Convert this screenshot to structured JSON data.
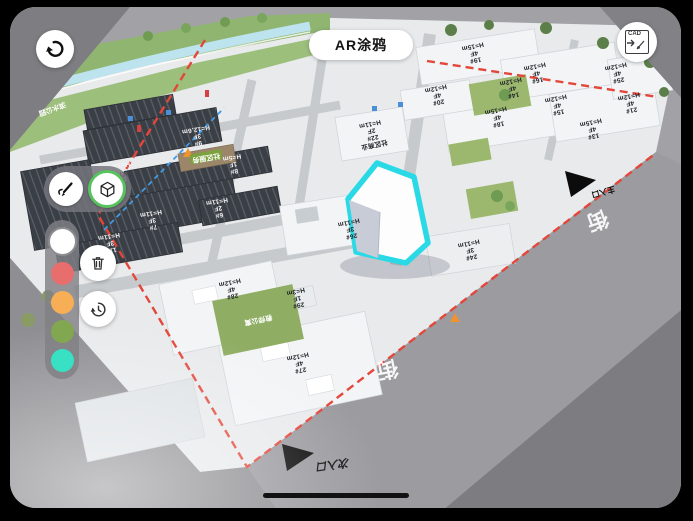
{
  "header": {
    "title": "AR涂鸦",
    "back_icon": "undo-arrow",
    "cad_icon": "CAD"
  },
  "tools": {
    "pen_icon": "pen-scribble",
    "model_icon": "cube",
    "selected_tool": "cube"
  },
  "palette": {
    "selected": "white",
    "colors": [
      {
        "name": "white",
        "hex": "#ffffff"
      },
      {
        "name": "red",
        "hex": "#e86e6e"
      },
      {
        "name": "orange",
        "hex": "#f8ae55"
      },
      {
        "name": "green",
        "hex": "#82a751"
      },
      {
        "name": "teal",
        "hex": "#38e0c4"
      }
    ]
  },
  "side_actions": {
    "delete_icon": "trash",
    "history_icon": "history-clock"
  },
  "map": {
    "highlight_color": "#2ad9e6",
    "boundary_color": "#e4463a",
    "buildings": [
      {
        "id": "9#",
        "floors": "3F",
        "height": "H=12.6m",
        "x": 197,
        "y": 136,
        "rot": 170,
        "theme": "dark"
      },
      {
        "id": "8#",
        "floors": "1F",
        "height": "H=5m",
        "x": 233,
        "y": 164,
        "rot": 170,
        "theme": "dark"
      },
      {
        "id": "10#",
        "floors": "4F",
        "height": "H=15m",
        "x": 120,
        "y": 172,
        "rot": 170,
        "theme": "dark"
      },
      {
        "id": "7#",
        "floors": "3F",
        "height": "H=11m",
        "x": 152,
        "y": 220,
        "rot": 170,
        "theme": "dark"
      },
      {
        "id": "6#",
        "floors": "2F",
        "height": "H=11m",
        "x": 218,
        "y": 208,
        "rot": 170,
        "theme": "dark"
      },
      {
        "id": "11#",
        "floors": "3F",
        "height": "H=11m",
        "x": 110,
        "y": 243,
        "rot": 170,
        "theme": "dark"
      },
      {
        "id": "22#",
        "floors": "2F",
        "height": "H=11m",
        "name": "社区商业",
        "x": 372,
        "y": 134,
        "rot": 168,
        "theme": "light"
      },
      {
        "id": "26#",
        "floors": "3F",
        "height": "H=11m",
        "x": 350,
        "y": 229,
        "rot": 168,
        "theme": "light"
      },
      {
        "id": "24#",
        "floors": "3F",
        "height": "H=11m",
        "x": 470,
        "y": 250,
        "rot": 168,
        "theme": "light"
      },
      {
        "id": "27#",
        "floors": "4F",
        "height": "H=12m",
        "x": 299,
        "y": 363,
        "rot": 168,
        "theme": "light"
      },
      {
        "id": "28#",
        "floors": "4F",
        "height": "H=12m",
        "x": 231,
        "y": 289,
        "rot": 168,
        "theme": "light"
      },
      {
        "id": "29#",
        "floors": "1F",
        "height": "H=3m",
        "x": 297,
        "y": 298,
        "rot": 168,
        "theme": "light"
      },
      {
        "id": "16#",
        "floors": "4F",
        "height": "H=12m",
        "x": 536,
        "y": 73,
        "rot": 168,
        "theme": "light"
      },
      {
        "id": "15#",
        "floors": "4F",
        "height": "H=12m",
        "x": 557,
        "y": 105,
        "rot": 168,
        "theme": "light"
      },
      {
        "id": "18#",
        "floors": "4F",
        "height": "H=15m",
        "x": 497,
        "y": 117,
        "rot": 168,
        "theme": "light"
      },
      {
        "id": "19#",
        "floors": "4F",
        "height": "H=15m",
        "x": 474,
        "y": 53,
        "rot": 168,
        "theme": "light"
      },
      {
        "id": "13#",
        "floors": "4F",
        "height": "H=15m",
        "x": 592,
        "y": 129,
        "rot": 168,
        "theme": "light"
      },
      {
        "id": "25#",
        "floors": "4F",
        "height": "H=12m",
        "x": 617,
        "y": 73,
        "rot": 168,
        "theme": "light"
      },
      {
        "id": "14#",
        "floors": "4F",
        "height": "H=12m",
        "x": 512,
        "y": 88,
        "rot": 168,
        "theme": "light"
      },
      {
        "id": "21#",
        "floors": "4F",
        "height": "H=12m",
        "x": 630,
        "y": 103,
        "rot": 168,
        "theme": "light"
      },
      {
        "id": "20#",
        "floors": "4F",
        "height": "H=12m",
        "x": 437,
        "y": 95,
        "rot": 168,
        "theme": "light"
      }
    ],
    "areas": [
      {
        "name": "教师公寓",
        "x": 258,
        "y": 319,
        "rot": 168,
        "chip": false
      },
      {
        "name": "社区服务",
        "x": 206,
        "y": 157,
        "rot": 170,
        "chip": true
      },
      {
        "name": "滨水公园",
        "x": 52,
        "y": 108,
        "rot": 160,
        "chip": false
      }
    ],
    "road_labels": [
      {
        "text": "街",
        "x": 597,
        "y": 219,
        "rot": 160
      },
      {
        "text": "街",
        "x": 387,
        "y": 368,
        "rot": 168
      }
    ],
    "entrances": [
      {
        "label": "主入口",
        "x": 603,
        "y": 191,
        "rot": 165,
        "style": "plain"
      },
      {
        "label": "次入口",
        "x": 333,
        "y": 463,
        "rot": 172,
        "style": "graffiti"
      }
    ]
  }
}
